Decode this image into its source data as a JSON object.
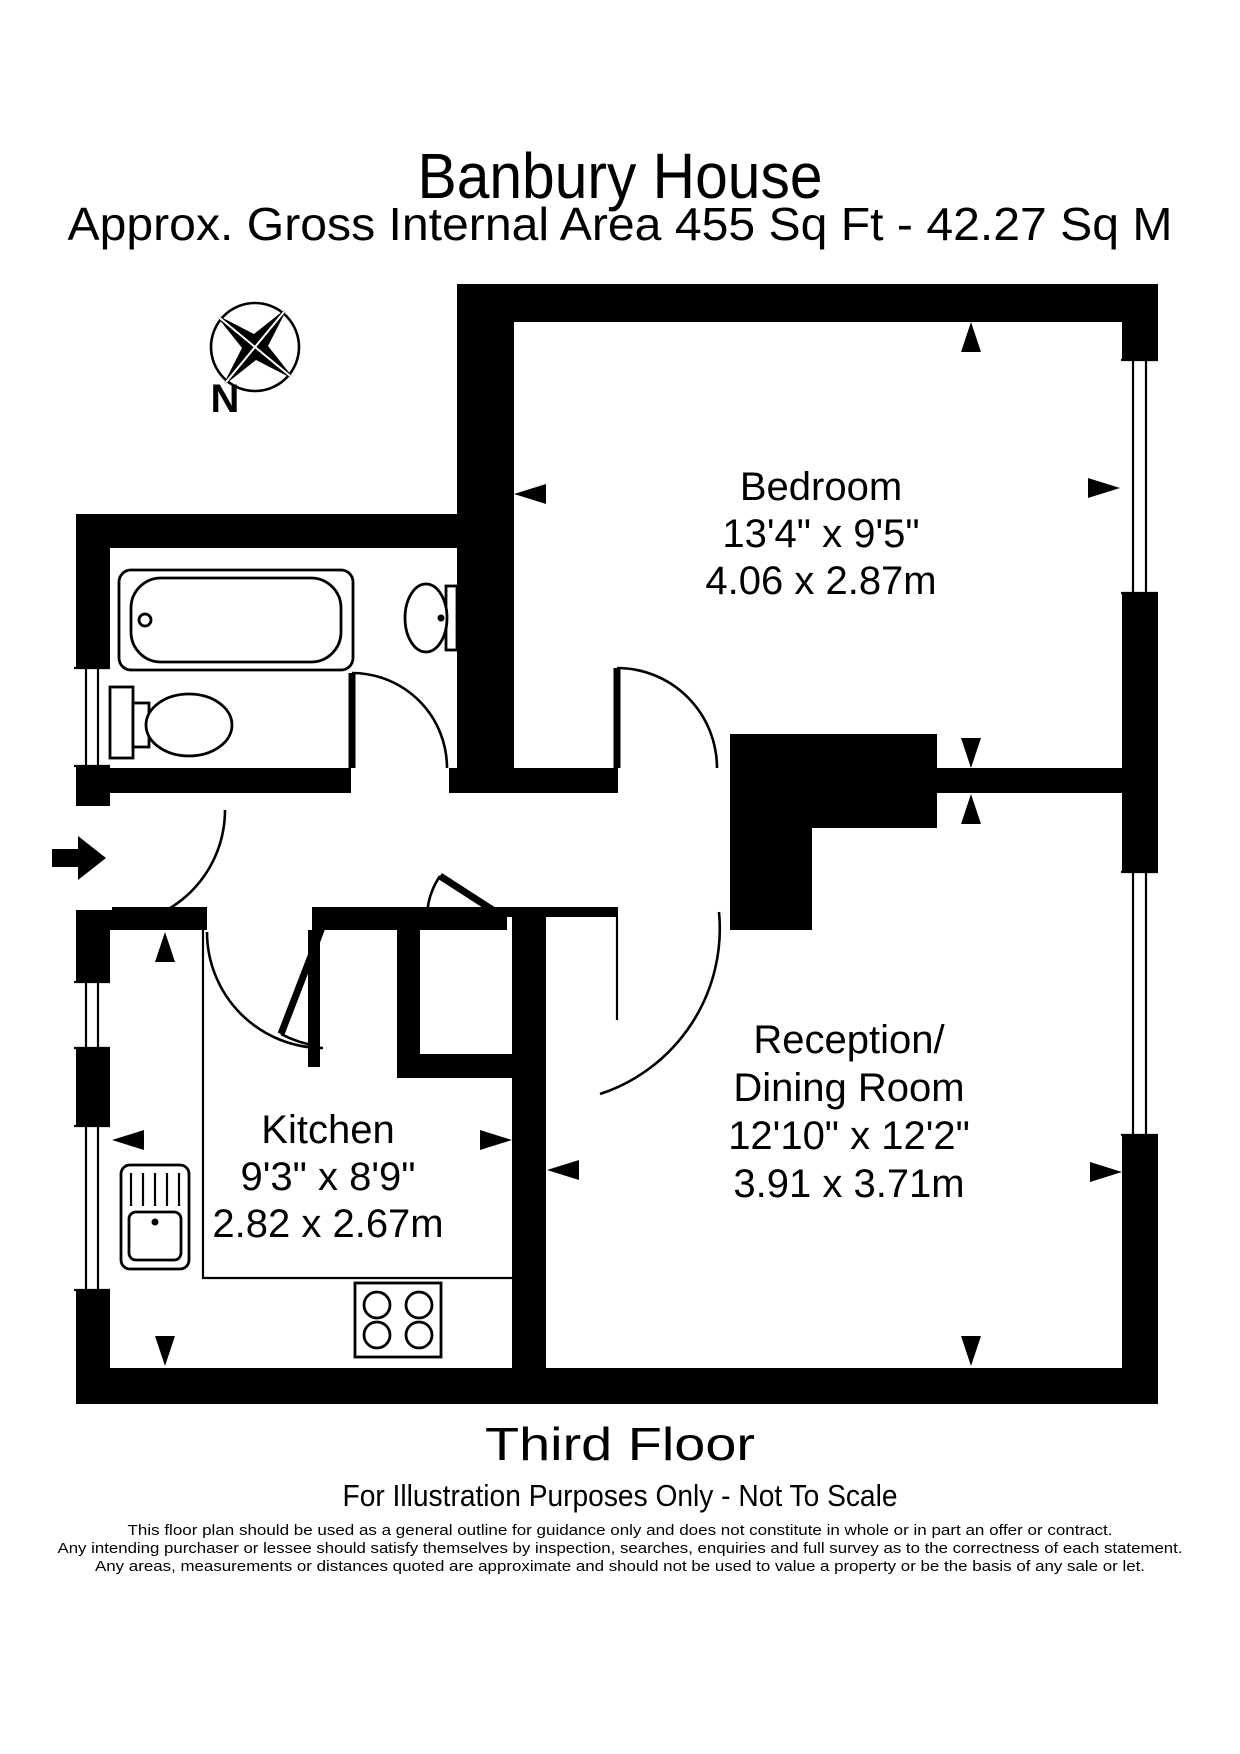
{
  "header": {
    "title": "Banbury House",
    "subtitle": "Approx. Gross Internal Area  455 Sq Ft  -  42.27 Sq M"
  },
  "compass": {
    "label": "N"
  },
  "rooms": {
    "bedroom": {
      "name": "Bedroom",
      "imperial": "13'4\" x 9'5\"",
      "metric": "4.06 x 2.87m"
    },
    "kitchen": {
      "name": "Kitchen",
      "imperial": "9'3\" x 8'9\"",
      "metric": "2.82 x 2.67m"
    },
    "reception": {
      "name_line1": "Reception/",
      "name_line2": "Dining Room",
      "imperial": "12'10\" x 12'2\"",
      "metric": "3.91 x 3.71m"
    }
  },
  "footer": {
    "floor": "Third Floor",
    "note": "For Illustration Purposes Only - Not To Scale",
    "disclaimer": [
      "This floor plan should be used as a general outline for guidance only and does not constitute in whole or in part an offer or contract.",
      "Any intending purchaser or lessee should satisfy themselves by inspection, searches, enquiries and full survey as to the correctness of each statement.",
      "Any areas, measurements or distances quoted are approximate and should not be used to value a property or be the basis of any sale or let."
    ]
  },
  "colors": {
    "ink": "#000000",
    "paper": "#ffffff"
  }
}
